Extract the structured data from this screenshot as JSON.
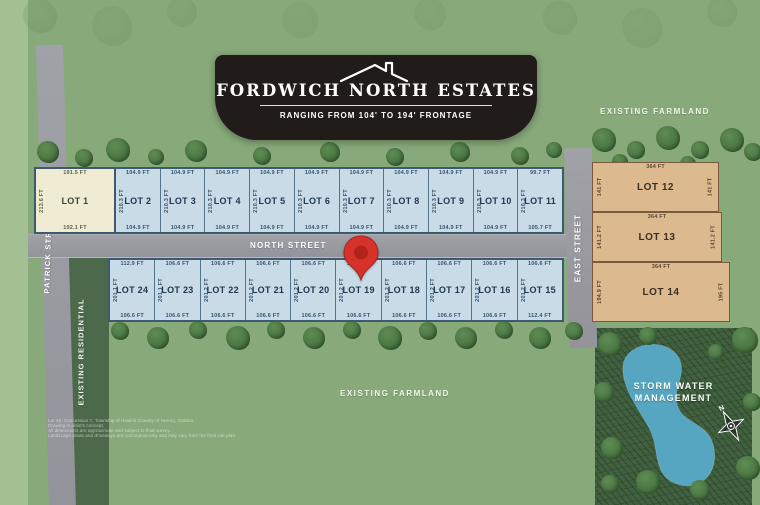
{
  "banner": {
    "title": "FORDWICH NORTH ESTATES",
    "subtitle": "RANGING FROM 104' TO 194' FRONTAGE"
  },
  "streets": {
    "north": "NORTH STREET",
    "east": "EAST STREET",
    "patrick": "PATRICK STREET."
  },
  "areas": {
    "existing_farmland_top": "EXISTING FARMLAND",
    "existing_farmland_bottom": "EXISTING FARMLAND",
    "existing_residential": "EXISTING RESIDENTIAL",
    "storm_water_line1": "STORM WATER",
    "storm_water_line2": "MANAGEMENT",
    "compass_north": "N"
  },
  "lots": {
    "north_row": [
      {
        "name": "LOT 1",
        "frontage_top": "191.5 FT",
        "frontage_bottom": "192.1 FT",
        "depth": "213.6 FT",
        "color": "cream"
      },
      {
        "name": "LOT 2",
        "frontage_top": "104.9 FT",
        "frontage_bottom": "104.9 FT",
        "depth": "210.3 FT",
        "color": "blue"
      },
      {
        "name": "LOT 3",
        "frontage_top": "104.9 FT",
        "frontage_bottom": "104.9 FT",
        "depth": "210.3 FT",
        "color": "blue"
      },
      {
        "name": "LOT 4",
        "frontage_top": "104.9 FT",
        "frontage_bottom": "104.9 FT",
        "depth": "210.3 FT",
        "color": "blue"
      },
      {
        "name": "LOT 5",
        "frontage_top": "104.9 FT",
        "frontage_bottom": "104.9 FT",
        "depth": "210.3 FT",
        "color": "blue"
      },
      {
        "name": "LOT 6",
        "frontage_top": "104.9 FT",
        "frontage_bottom": "104.9 FT",
        "depth": "210.3 FT",
        "color": "blue"
      },
      {
        "name": "LOT 7",
        "frontage_top": "104.9 FT",
        "frontage_bottom": "104.9 FT",
        "depth": "210.3 FT",
        "color": "blue"
      },
      {
        "name": "LOT 8",
        "frontage_top": "104.9 FT",
        "frontage_bottom": "104.9 FT",
        "depth": "210.3 FT",
        "color": "blue"
      },
      {
        "name": "LOT 9",
        "frontage_top": "104.9 FT",
        "frontage_bottom": "104.9 FT",
        "depth": "210.3 FT",
        "color": "blue"
      },
      {
        "name": "LOT 10",
        "frontage_top": "104.9 FT",
        "frontage_bottom": "104.9 FT",
        "depth": "210.3 FT",
        "color": "blue"
      },
      {
        "name": "LOT 11",
        "frontage_top": "99.7 FT",
        "frontage_bottom": "105.7 FT",
        "depth": "210.3 FT",
        "color": "blue"
      }
    ],
    "south_row": [
      {
        "name": "LOT 24",
        "frontage_top": "112.9 FT",
        "frontage_bottom": "106.6 FT",
        "depth": "201.1 FT"
      },
      {
        "name": "LOT 23",
        "frontage_top": "106.6 FT",
        "frontage_bottom": "106.6 FT",
        "depth": "201.1 FT"
      },
      {
        "name": "LOT 22",
        "frontage_top": "106.6 FT",
        "frontage_bottom": "106.6 FT",
        "depth": "201.2 FT"
      },
      {
        "name": "LOT 21",
        "frontage_top": "106.6 FT",
        "frontage_bottom": "106.6 FT",
        "depth": "201.2 FT"
      },
      {
        "name": "LOT 20",
        "frontage_top": "106.6 FT",
        "frontage_bottom": "106.6 FT",
        "depth": "201.2 FT"
      },
      {
        "name": "LOT 19",
        "frontage_top": "106.6 FT",
        "frontage_bottom": "106.6 FT",
        "depth": "201.2 FT",
        "pin": true
      },
      {
        "name": "LOT 18",
        "frontage_top": "106.6 FT",
        "frontage_bottom": "106.6 FT",
        "depth": "201.2 FT"
      },
      {
        "name": "LOT 17",
        "frontage_top": "106.6 FT",
        "frontage_bottom": "106.6 FT",
        "depth": "201.2 FT"
      },
      {
        "name": "LOT 16",
        "frontage_top": "106.6 FT",
        "frontage_bottom": "106.6 FT",
        "depth": "201.2 FT"
      },
      {
        "name": "LOT 15",
        "frontage_top": "106.6 FT",
        "frontage_bottom": "112.4 FT",
        "depth": "201.2 FT"
      }
    ],
    "east_column": [
      {
        "name": "LOT 12",
        "width_top": "364 FT",
        "depth_left": "141 FT",
        "depth_right": "141 FT"
      },
      {
        "name": "LOT 13",
        "width_top": "364 FT",
        "depth_left": "141.2 FT",
        "depth_right": "141.2 FT"
      },
      {
        "name": "LOT 14",
        "width_top": "364 FT",
        "depth_left": "194.9 FT",
        "depth_right": "195 FT"
      }
    ]
  },
  "fine_print": [
    "Lot 49, Concession 7, Township of Howick (County of Huron), Ontario",
    "Drawing is artist's concept.",
    "All dimensions are approximate and subject to final survey.",
    "Landscape areas and driveways are conceptual only and may vary from the final site plan."
  ],
  "colors": {
    "background": "#88aa7b",
    "street_grey": "#9a9aa0",
    "lot_blue": "#c8dbe7",
    "lot_cream": "#f0ecd4",
    "lot_tan": "#dcb98f",
    "pond_blue": "#57a6c1",
    "pin_red": "#d6322b",
    "banner_bg": "#211c1a"
  }
}
